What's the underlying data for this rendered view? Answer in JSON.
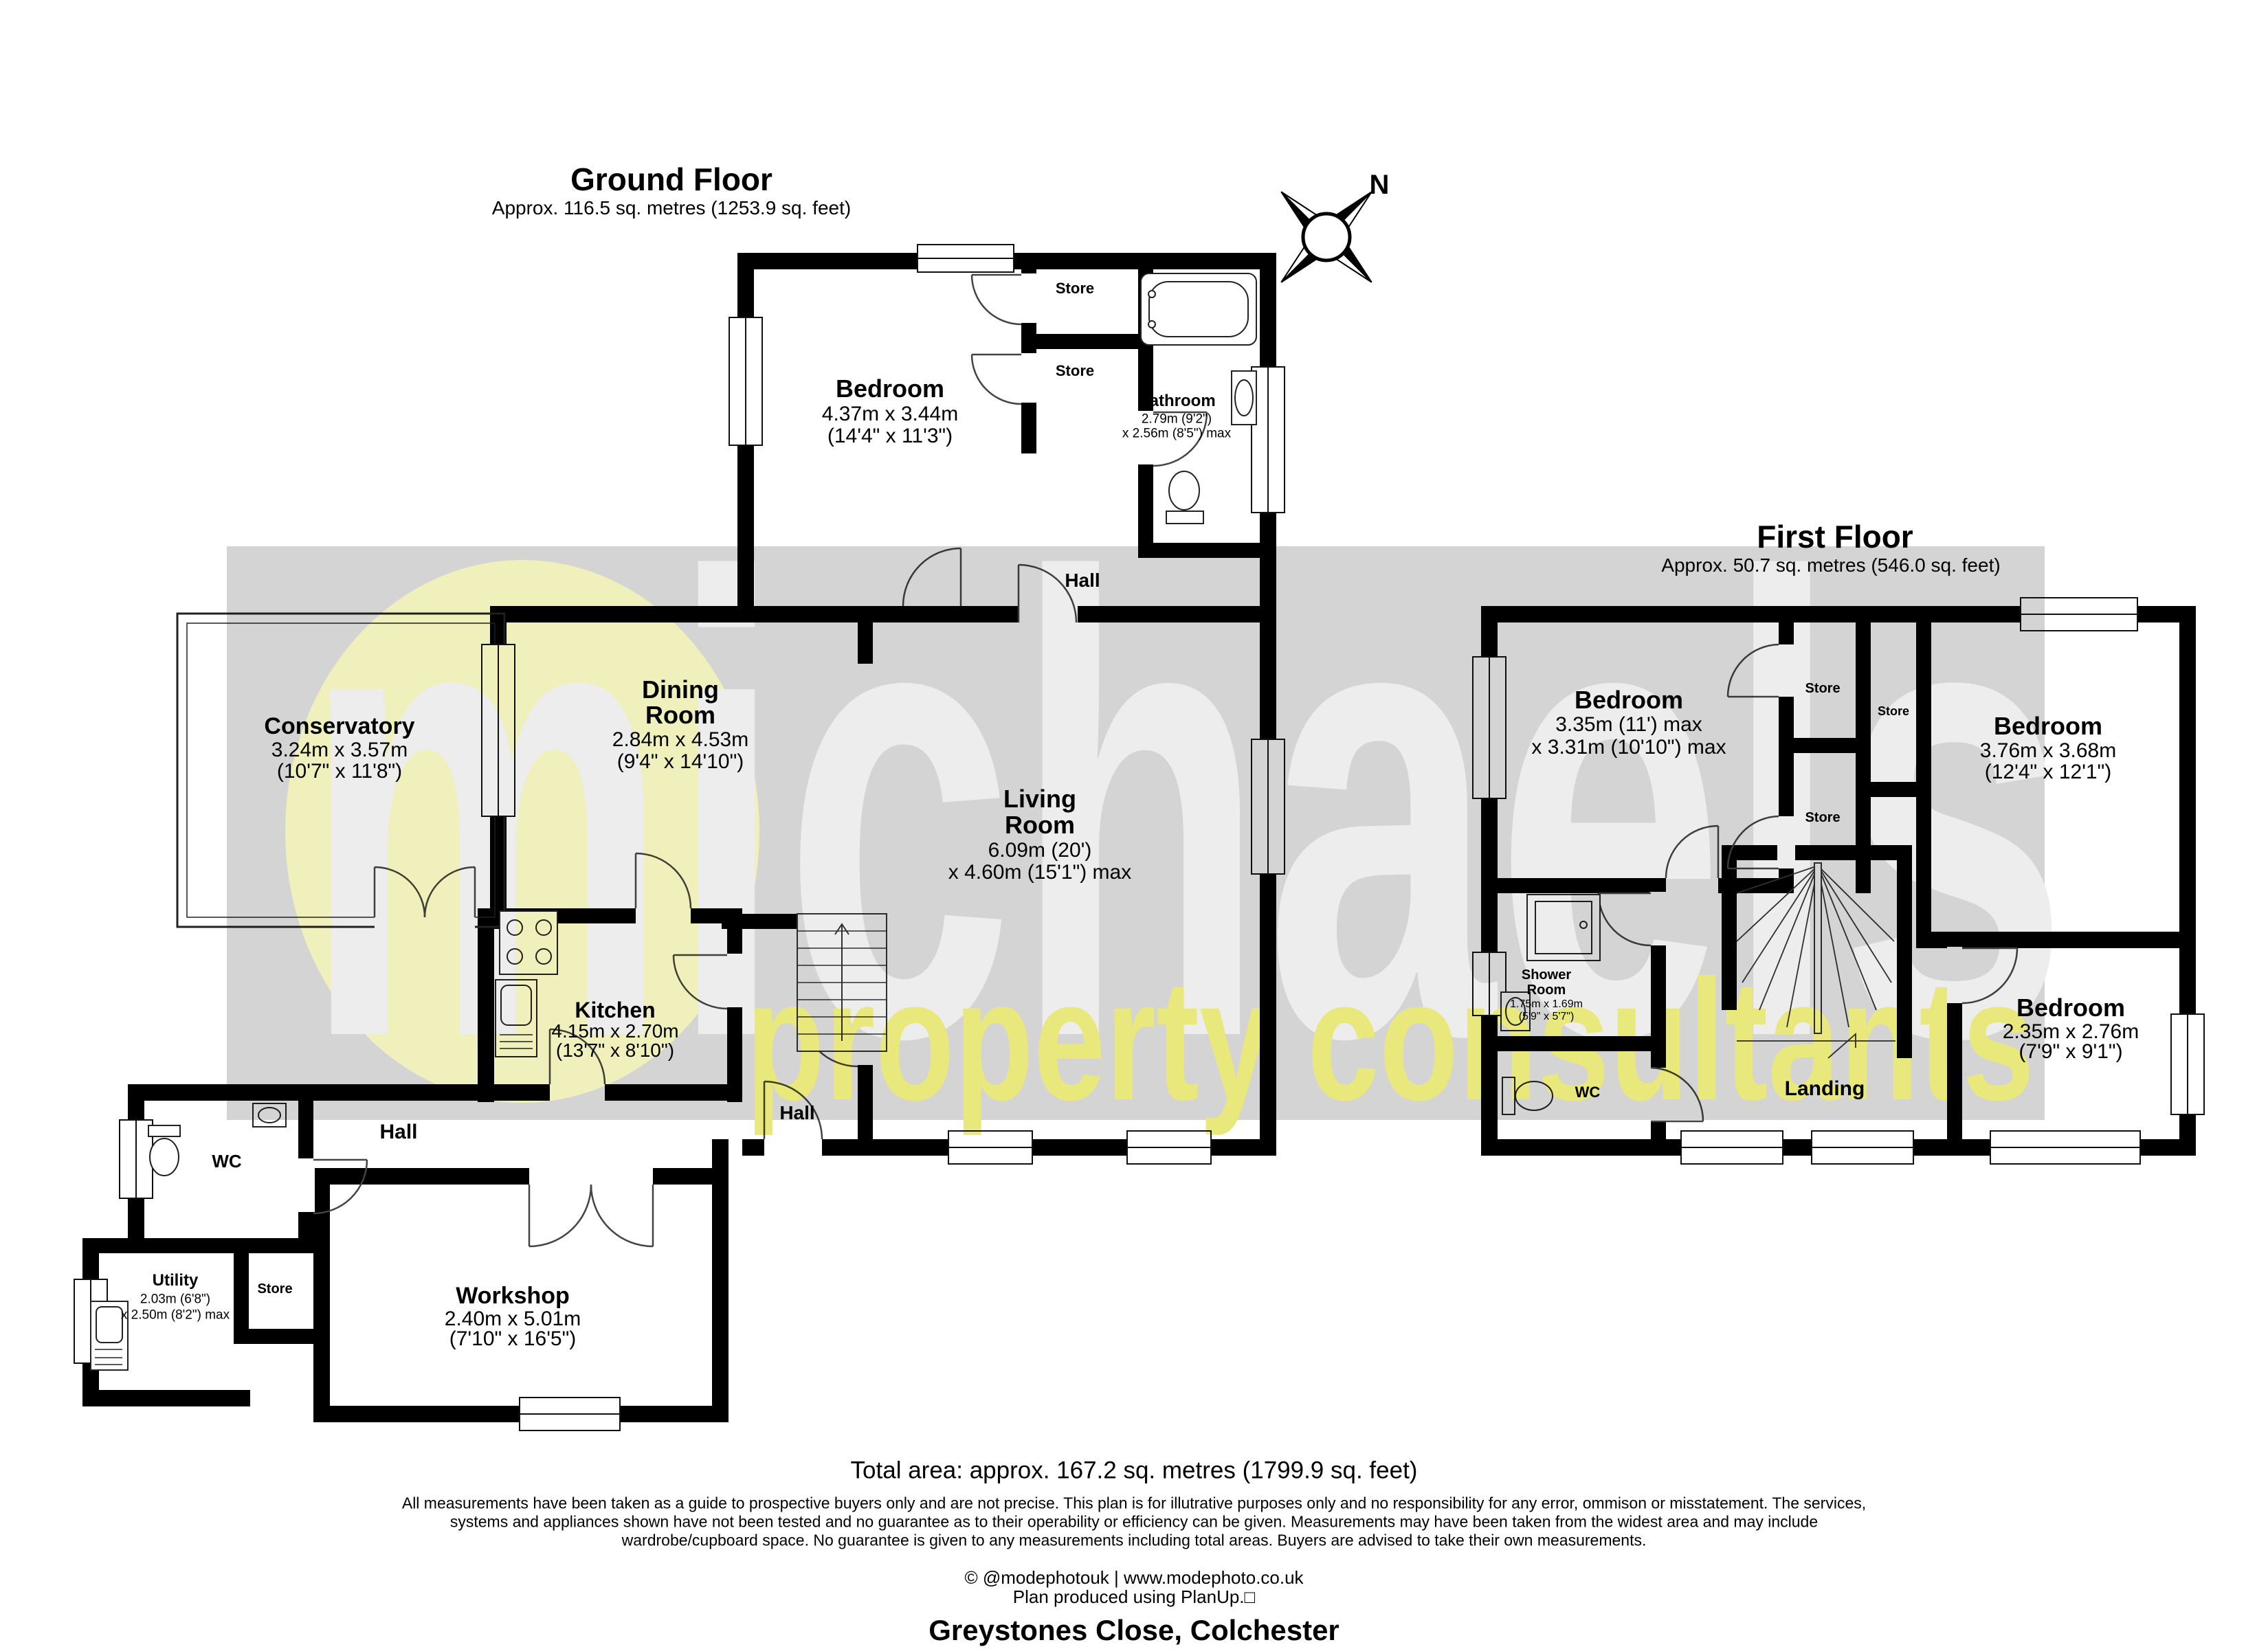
{
  "watermark": {
    "brand": "michaels",
    "tagline": "property consultants"
  },
  "compass": {
    "north_label": "N"
  },
  "ground_floor": {
    "title": "Ground Floor",
    "area": "Approx. 116.5 sq. metres (1253.9 sq. feet)",
    "rooms": {
      "bedroom": {
        "name": "Bedroom",
        "dims_metric": "4.37m x 3.44m",
        "dims_imperial": "(14'4\" x 11'3\")"
      },
      "store_upper": {
        "name": "Store"
      },
      "store_lower": {
        "name": "Store"
      },
      "bathroom": {
        "name": "Bathroom",
        "dims_metric": "2.79m (9'2\")",
        "dims_imperial": "x 2.56m (8'5\") max"
      },
      "hall_wing": {
        "name": "Hall"
      },
      "conservatory": {
        "name": "Conservatory",
        "dims_metric": "3.24m x 3.57m",
        "dims_imperial": "(10'7\" x 11'8\")"
      },
      "dining_room": {
        "name_line1": "Dining",
        "name_line2": "Room",
        "dims_metric": "2.84m x 4.53m",
        "dims_imperial": "(9'4\" x 14'10\")"
      },
      "living_room": {
        "name_line1": "Living",
        "name_line2": "Room",
        "dims_metric": "6.09m (20')",
        "dims_imperial": "x 4.60m (15'1\") max"
      },
      "kitchen": {
        "name": "Kitchen",
        "dims_metric": "4.15m x 2.70m",
        "dims_imperial": "(13'7\" x 8'10\")"
      },
      "hall_middle": {
        "name": "Hall"
      },
      "wc": {
        "name": "WC"
      },
      "hall_lower": {
        "name": "Hall"
      },
      "store_annex": {
        "name": "Store"
      },
      "utility": {
        "name": "Utility",
        "dims_metric": "2.03m (6'8\")",
        "dims_imperial": "x 2.50m (8'2\") max"
      },
      "workshop": {
        "name": "Workshop",
        "dims_metric": "2.40m x 5.01m",
        "dims_imperial": "(7'10\" x 16'5\")"
      }
    }
  },
  "first_floor": {
    "title": "First Floor",
    "area": "Approx. 50.7 sq. metres (546.0 sq. feet)",
    "rooms": {
      "bedroom_left": {
        "name": "Bedroom",
        "dims_metric": "3.35m (11') max",
        "dims_imperial": "x 3.31m (10'10\") max"
      },
      "store_top": {
        "name": "Store"
      },
      "store_middle": {
        "name": "Store"
      },
      "store_bottom": {
        "name": "Store"
      },
      "bedroom_right": {
        "name": "Bedroom",
        "dims_metric": "3.76m x 3.68m",
        "dims_imperial": "(12'4\" x 12'1\")"
      },
      "shower_room": {
        "name_line1": "Shower",
        "name_line2": "Room",
        "dims_metric": "1.75m x 1.69m",
        "dims_imperial": "(5'9\" x 5'7\")"
      },
      "wc": {
        "name": "WC"
      },
      "landing": {
        "name": "Landing"
      },
      "bedroom_small": {
        "name": "Bedroom",
        "dims_metric": "2.35m x 2.76m",
        "dims_imperial": "(7'9\" x 9'1\")"
      }
    }
  },
  "footer": {
    "total_area": "Total area: approx. 167.2 sq. metres (1799.9 sq. feet)",
    "disclaimer_line1": "All measurements have been taken as a guide to prospective buyers only and are not precise. This plan is for illutrative purposes only and no responsibility for any error, ommison or misstatement. The services,",
    "disclaimer_line2": "systems and appliances shown have not been tested and no guarantee as to their operability or efficiency can be given. Measurements may have been taken from the widest area and may include",
    "disclaimer_line3": "wardrobe/cupboard space. No guarantee is given to any measurements including total areas. Buyers are advised to take their own measurements.",
    "credit": "© @modephotouk | www.modephoto.co.uk",
    "software": "Plan produced using PlanUp.□",
    "address": "Greystones Close, Colchester"
  }
}
